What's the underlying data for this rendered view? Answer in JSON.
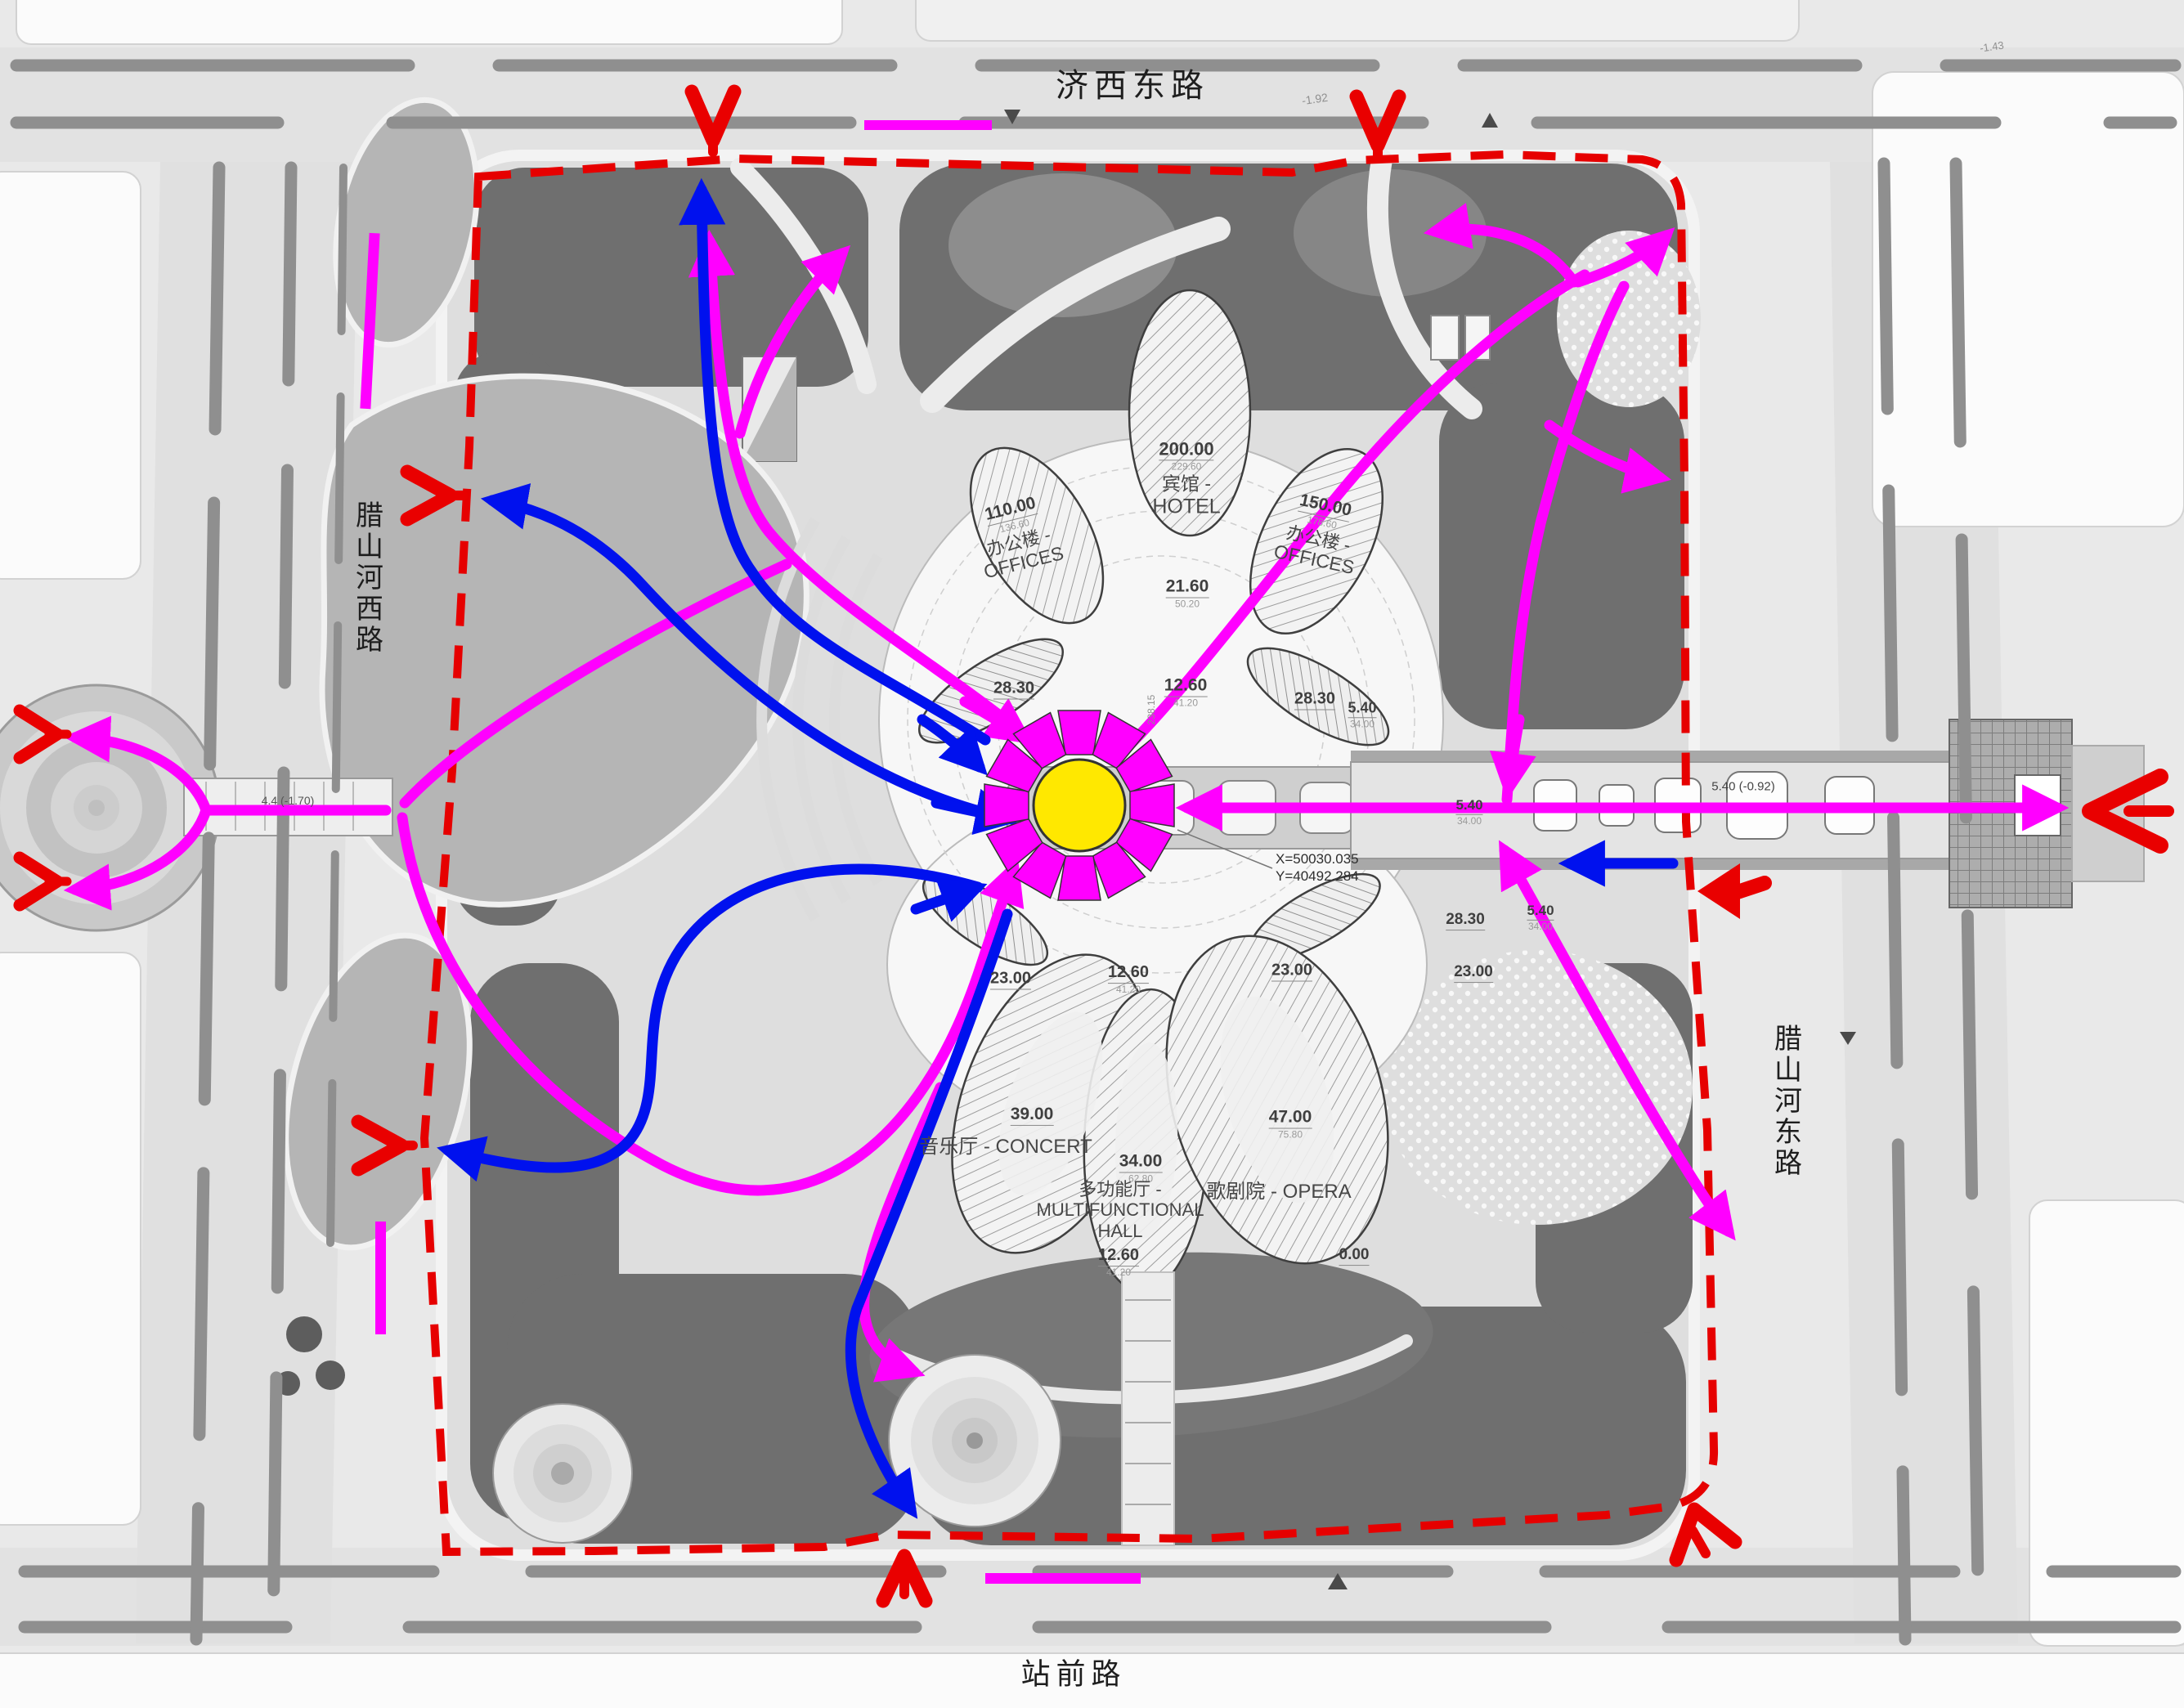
{
  "roads": {
    "north": "济西东路",
    "west": "腊山河西路",
    "east": "腊山河东路",
    "south": "站前路"
  },
  "buildings": {
    "offices_west": {
      "elev": "110.00",
      "elev_sub": "136.60",
      "cn": "办公楼 -",
      "en": "OFFICES"
    },
    "hotel": {
      "elev": "200.00",
      "elev_sub": "229.60",
      "cn": "宾馆 -",
      "en": "HOTEL"
    },
    "offices_east": {
      "elev": "150.00",
      "elev_sub": "178.60",
      "cn": "办公楼 -",
      "en": "OFFICES"
    },
    "concert": {
      "elev": "39.00",
      "cn": "音乐厅 -",
      "en": "CONCERT"
    },
    "multifunctional_hall": {
      "elev": "34.00",
      "elev_sub": "62.80",
      "cn": "多功能厅 -",
      "en": "MULTIFUNCTIONAL",
      "en2": "HALL"
    },
    "opera": {
      "elev": "47.00",
      "elev_sub": "75.80",
      "cn": "歌剧院 -",
      "en": "OPERA"
    }
  },
  "levels": {
    "core_upper": {
      "v": "21.60",
      "s": "50.20"
    },
    "core_mid": {
      "v": "12.60",
      "s": "41.20"
    },
    "pod_nw": {
      "v": "28.30"
    },
    "pod_ne": {
      "v": "28.30"
    },
    "pod_ne_s": {
      "v": "5.40",
      "s": "34.00"
    },
    "pod_sw": {
      "v": "23.00"
    },
    "forecourt": {
      "v": "12.60",
      "s": "41.20"
    },
    "pod_se": {
      "v": "23.00"
    },
    "south_court": {
      "v": "12.60",
      "s": "41.20"
    },
    "ground": {
      "v": "0.00"
    },
    "link_w": {
      "v": "5.40",
      "s": "34.00"
    },
    "link_s": {
      "v": "5.40",
      "s": "34.00"
    },
    "pod_e": {
      "v": "28.30"
    },
    "pod_e2": {
      "v": "23.00"
    }
  },
  "coordinates": {
    "x": "X=50030.035",
    "y": "Y=40492.284"
  },
  "annotations": {
    "bridge_west": "4.4 (-1.70)",
    "east_link": "5.40 (-0.92)",
    "spot_a": "-1.92",
    "spot_b": "-1.43",
    "axis_tick": "238.15"
  },
  "colors": {
    "primary_flow": "#ff00ff",
    "secondary_flow": "#0011ee",
    "entry_arrow": "#e90000",
    "boundary_dash": "#e60000",
    "focal_sun": "#ffe800"
  }
}
